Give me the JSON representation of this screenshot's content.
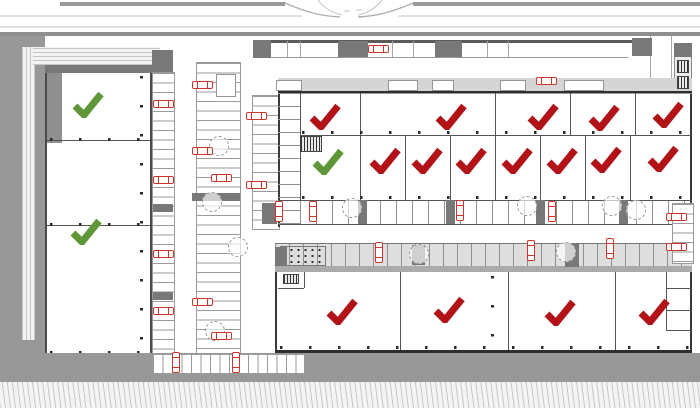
{
  "title": "site-plan-unit-approval-overview",
  "palette": {
    "approved_green": "#5f9638",
    "rejected_red": "#b11318",
    "car_red": "#cb362c",
    "road_gray": "#989898",
    "wall_dark": "#2e2e2e"
  },
  "summary": {
    "approved_units": 3,
    "rejected_units": 16,
    "total_checks": 19
  },
  "checks": [
    {
      "id": "west-hall-unit-1",
      "status": "approved",
      "x": 88,
      "y": 104
    },
    {
      "id": "west-hall-unit-3",
      "status": "approved",
      "x": 86,
      "y": 231
    },
    {
      "id": "north-hall-r2-u1",
      "status": "approved",
      "x": 328,
      "y": 161
    },
    {
      "id": "north-hall-r1-u1",
      "status": "rejected",
      "x": 325,
      "y": 116
    },
    {
      "id": "north-hall-r1-u2",
      "status": "rejected",
      "x": 451,
      "y": 116
    },
    {
      "id": "north-hall-r1-u3",
      "status": "rejected",
      "x": 543,
      "y": 116
    },
    {
      "id": "north-hall-r1-u4",
      "status": "rejected",
      "x": 604,
      "y": 117
    },
    {
      "id": "north-hall-r1-u5",
      "status": "rejected",
      "x": 668,
      "y": 114
    },
    {
      "id": "north-hall-r2-u2",
      "status": "rejected",
      "x": 385,
      "y": 160
    },
    {
      "id": "north-hall-r2-u3",
      "status": "rejected",
      "x": 427,
      "y": 160
    },
    {
      "id": "north-hall-r2-u4",
      "status": "rejected",
      "x": 471,
      "y": 160
    },
    {
      "id": "north-hall-r2-u5",
      "status": "rejected",
      "x": 517,
      "y": 160
    },
    {
      "id": "north-hall-r2-u6",
      "status": "rejected",
      "x": 562,
      "y": 160
    },
    {
      "id": "north-hall-r2-u7",
      "status": "rejected",
      "x": 606,
      "y": 159
    },
    {
      "id": "north-hall-r2-u8",
      "status": "rejected",
      "x": 663,
      "y": 158
    },
    {
      "id": "south-hall-u1",
      "status": "rejected",
      "x": 342,
      "y": 311
    },
    {
      "id": "south-hall-u2",
      "status": "rejected",
      "x": 449,
      "y": 309
    },
    {
      "id": "south-hall-u3",
      "status": "rejected",
      "x": 560,
      "y": 312
    },
    {
      "id": "south-hall-u4",
      "status": "rejected",
      "x": 654,
      "y": 311
    }
  ],
  "cars": [
    {
      "x": 378,
      "y": 49,
      "dir": "h"
    },
    {
      "x": 546,
      "y": 81,
      "dir": "h"
    },
    {
      "x": 163,
      "y": 104,
      "dir": "h"
    },
    {
      "x": 163,
      "y": 180,
      "dir": "h"
    },
    {
      "x": 163,
      "y": 254,
      "dir": "h"
    },
    {
      "x": 163,
      "y": 311,
      "dir": "h"
    },
    {
      "x": 202,
      "y": 85,
      "dir": "h"
    },
    {
      "x": 202,
      "y": 151,
      "dir": "h"
    },
    {
      "x": 221,
      "y": 178,
      "dir": "h"
    },
    {
      "x": 202,
      "y": 302,
      "dir": "h"
    },
    {
      "x": 221,
      "y": 336,
      "dir": "h"
    },
    {
      "x": 256,
      "y": 116,
      "dir": "h"
    },
    {
      "x": 256,
      "y": 185,
      "dir": "h"
    },
    {
      "x": 676,
      "y": 217,
      "dir": "h"
    },
    {
      "x": 676,
      "y": 247,
      "dir": "h"
    },
    {
      "x": 279,
      "y": 211,
      "dir": "v"
    },
    {
      "x": 313,
      "y": 211,
      "dir": "v"
    },
    {
      "x": 460,
      "y": 210,
      "dir": "v"
    },
    {
      "x": 552,
      "y": 211,
      "dir": "v"
    },
    {
      "x": 379,
      "y": 252,
      "dir": "v"
    },
    {
      "x": 531,
      "y": 250,
      "dir": "v"
    },
    {
      "x": 610,
      "y": 248,
      "dir": "v"
    },
    {
      "x": 176,
      "y": 362,
      "dir": "v"
    },
    {
      "x": 236,
      "y": 362,
      "dir": "v"
    }
  ],
  "trees": [
    {
      "x": 219,
      "y": 146
    },
    {
      "x": 212,
      "y": 202
    },
    {
      "x": 238,
      "y": 247
    },
    {
      "x": 215,
      "y": 331
    },
    {
      "x": 352,
      "y": 208
    },
    {
      "x": 527,
      "y": 206
    },
    {
      "x": 612,
      "y": 206
    },
    {
      "x": 419,
      "y": 254
    },
    {
      "x": 566,
      "y": 252
    },
    {
      "x": 636,
      "y": 210
    }
  ],
  "blocks": [
    {
      "x": 253,
      "y": 40,
      "w": 18,
      "h": 18
    },
    {
      "x": 338,
      "y": 41,
      "w": 30,
      "h": 16
    },
    {
      "x": 435,
      "y": 41,
      "w": 27,
      "h": 16
    },
    {
      "x": 192,
      "y": 193,
      "w": 48,
      "h": 8
    },
    {
      "x": 152,
      "y": 50,
      "w": 21,
      "h": 22
    },
    {
      "x": 153,
      "y": 204,
      "w": 20,
      "h": 8
    },
    {
      "x": 153,
      "y": 292,
      "w": 20,
      "h": 8
    },
    {
      "x": 358,
      "y": 200,
      "w": 9,
      "h": 24
    },
    {
      "x": 446,
      "y": 200,
      "w": 9,
      "h": 24
    },
    {
      "x": 536,
      "y": 200,
      "w": 9,
      "h": 24
    },
    {
      "x": 619,
      "y": 200,
      "w": 9,
      "h": 24
    },
    {
      "x": 262,
      "y": 203,
      "w": 15,
      "h": 21
    },
    {
      "x": 412,
      "y": 245,
      "w": 13,
      "h": 20
    },
    {
      "x": 565,
      "y": 243,
      "w": 14,
      "h": 24
    },
    {
      "x": 275,
      "y": 247,
      "w": 12,
      "h": 19
    },
    {
      "x": 632,
      "y": 38,
      "w": 20,
      "h": 18
    },
    {
      "x": 674,
      "y": 43,
      "w": 18,
      "h": 14
    }
  ],
  "cells": [
    {
      "x": 276,
      "y": 80,
      "w": 26,
      "h": 11
    },
    {
      "x": 388,
      "y": 80,
      "w": 30,
      "h": 11
    },
    {
      "x": 432,
      "y": 80,
      "w": 22,
      "h": 11
    },
    {
      "x": 500,
      "y": 80,
      "w": 26,
      "h": 11
    },
    {
      "x": 564,
      "y": 80,
      "w": 40,
      "h": 11
    },
    {
      "x": 216,
      "y": 74,
      "w": 20,
      "h": 23
    }
  ],
  "glyphs": [
    {
      "x": 677,
      "y": 60,
      "w": 12,
      "h": 13
    },
    {
      "x": 677,
      "y": 76,
      "w": 12,
      "h": 13
    },
    {
      "x": 300,
      "y": 136,
      "w": 22,
      "h": 16
    },
    {
      "x": 283,
      "y": 274,
      "w": 16,
      "h": 10
    }
  ]
}
